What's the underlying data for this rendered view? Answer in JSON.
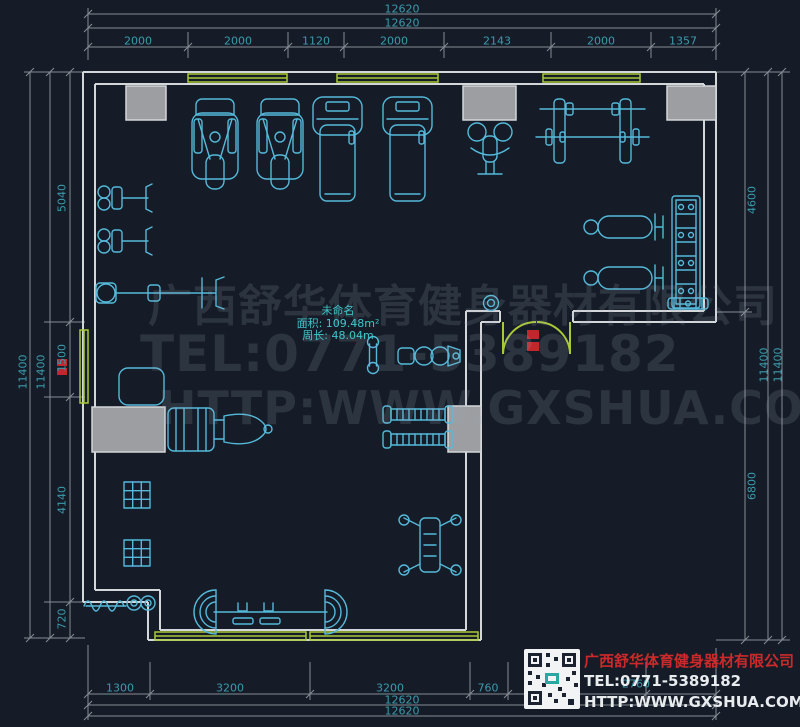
{
  "drawing": {
    "room_label": {
      "name": "未命名",
      "area": "面积: 109.48m²",
      "perimeter": "周长: 48.04m"
    },
    "dimensions": {
      "top": {
        "totals": [
          "12620",
          "12620"
        ],
        "segments": [
          "2000",
          "2000",
          "1120",
          "2000",
          "2143",
          "2000",
          "1357"
        ]
      },
      "left": {
        "totals": [
          "11400",
          "11400"
        ],
        "segments": [
          "5040",
          "1500",
          "4140",
          "720"
        ]
      },
      "right": {
        "totals": [
          "11400",
          "11400"
        ],
        "segments": [
          "4600",
          "6800"
        ]
      },
      "bottom": {
        "totals": [
          "12620",
          "12620"
        ],
        "segments": [
          "1300",
          "3200",
          "3200",
          "760",
          "2760"
        ]
      }
    },
    "equipment": [
      "multi-station-gym",
      "multi-station-gym",
      "treadmill",
      "treadmill",
      "pec-deck-machine",
      "barbell-rack",
      "flat-bench",
      "flat-bench",
      "dumbbell-rack",
      "bench-press-station",
      "lat-machine",
      "lat-machine",
      "shoulder-press-machine",
      "weight-ring",
      "dumbbell",
      "seated-row-machine",
      "exercise-mat",
      "leg-press-machine",
      "plate-rack",
      "window-grid",
      "window-grid",
      "cable-station",
      "barbell-station",
      "battle-rope",
      "double-entry-door"
    ]
  },
  "watermark": {
    "line1": "广西舒华体育健身器材有限公司",
    "line2": "TEL:0771-5389182",
    "line3": "HTTP:WWW.GXSHUA.COM"
  },
  "info_panel": {
    "company": "广西舒华体育健身器材有限公司",
    "tel": "TEL:0771-5389182",
    "url": "HTTP:WWW.GXSHUA.COM"
  },
  "colors": {
    "background": "#151c27",
    "wall": "#d4d7da",
    "equipment": "#55b9da",
    "window_green": "#a9c937",
    "dimension_line": "#878d95",
    "dimension_text": "#3b9aab",
    "room_label_text": "#3fc6cb",
    "column_fill": "#9c9ea1",
    "door_tag_red": "#c1272d",
    "panel_company_red": "#cc2a2a"
  }
}
